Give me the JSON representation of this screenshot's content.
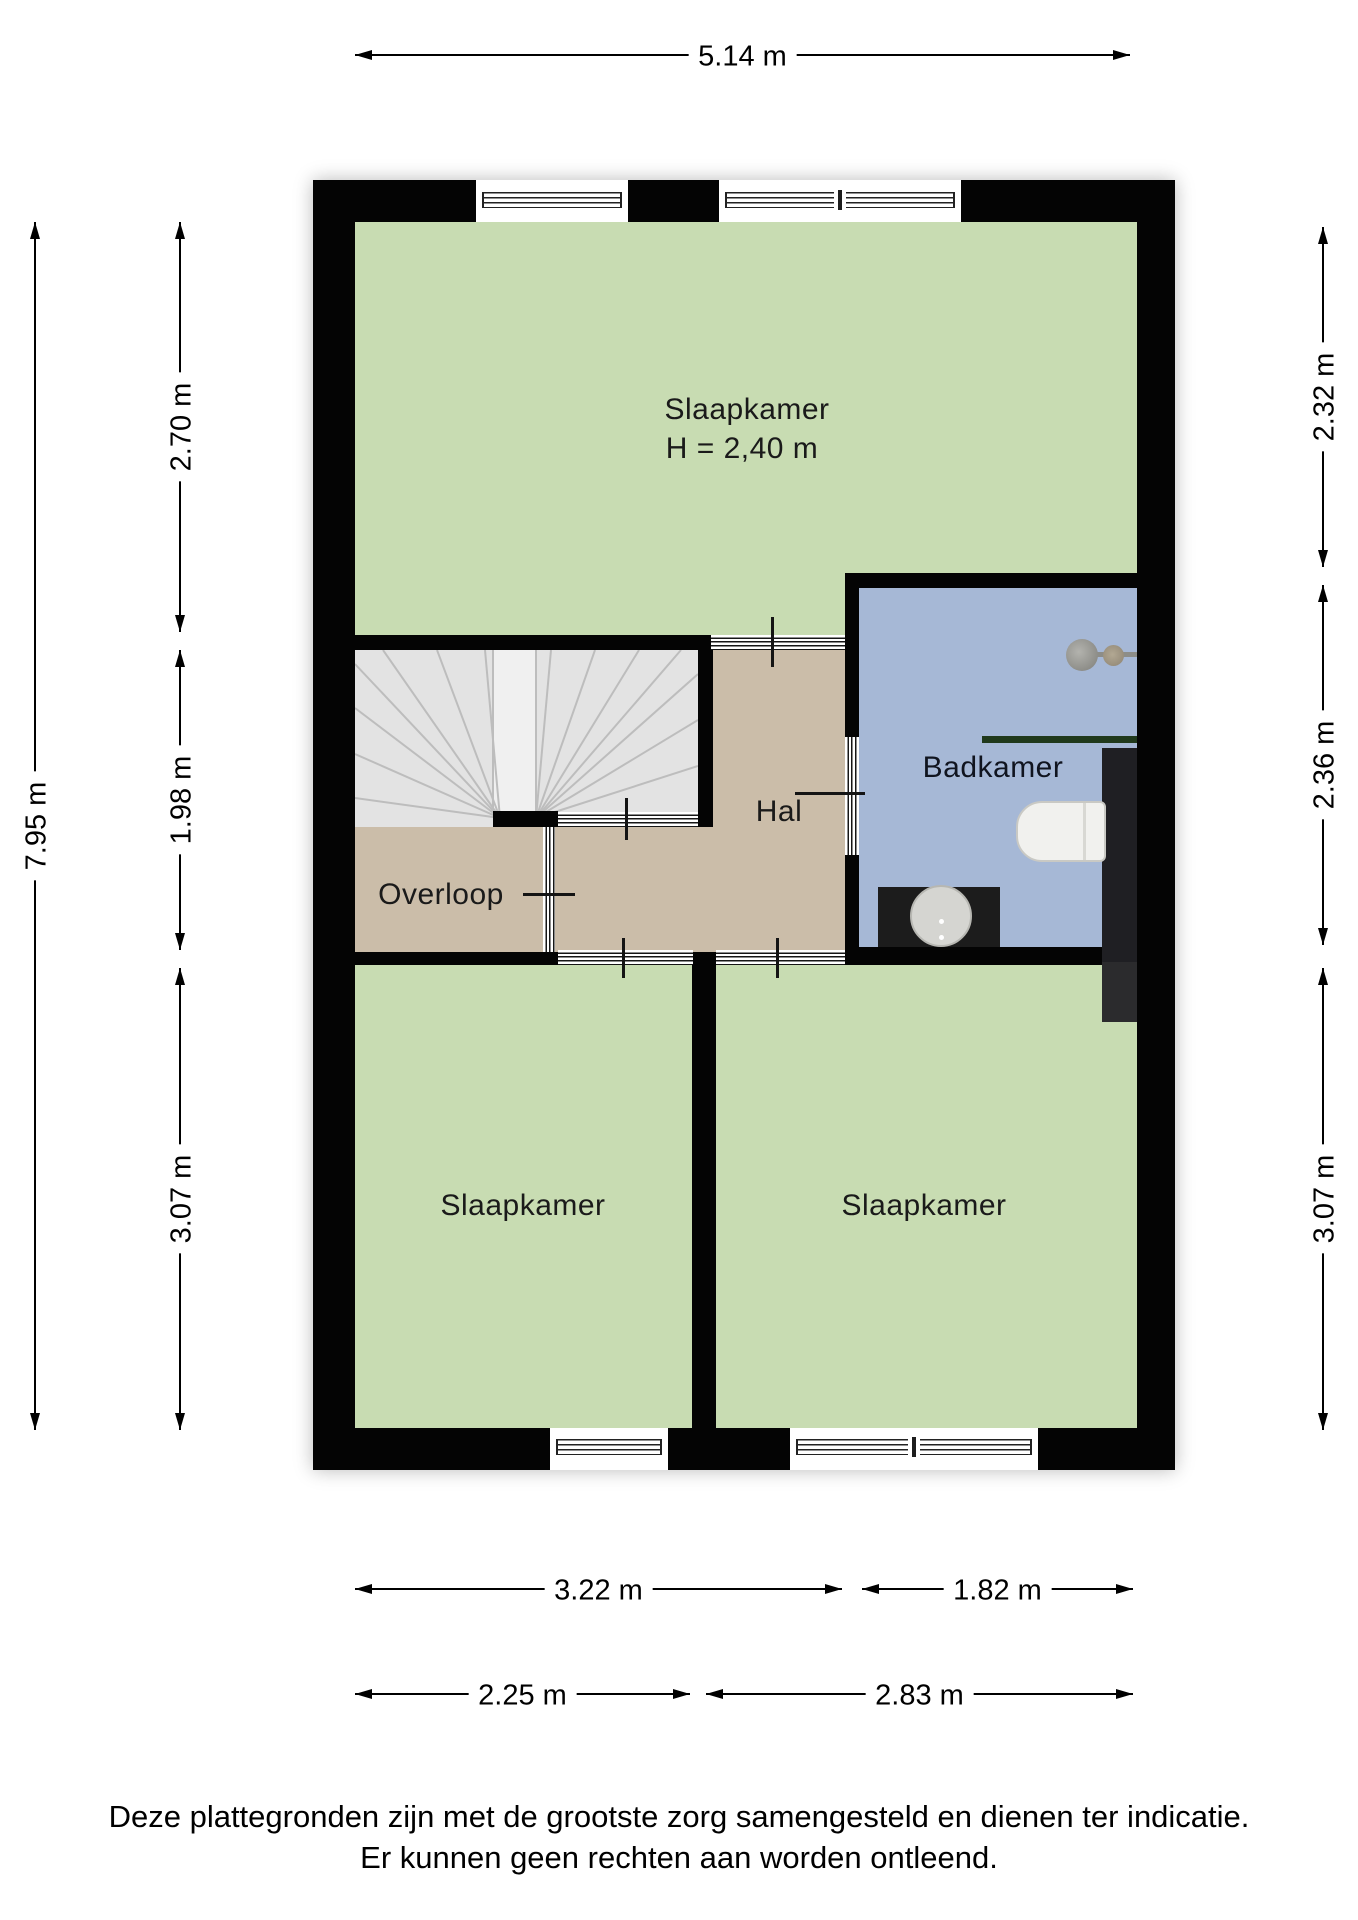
{
  "dimensions": {
    "top_width": "5.14 m",
    "left_total": "7.95 m",
    "left_segments": [
      "2.70 m",
      "1.98 m",
      "3.07 m"
    ],
    "right_segments": [
      "2.32 m",
      "2.36 m",
      "3.07 m"
    ],
    "bottom_row1": [
      "3.22 m",
      "1.82 m"
    ],
    "bottom_row2": [
      "2.25 m",
      "2.83 m"
    ]
  },
  "rooms": {
    "bedroom_top": {
      "label": "Slaapkamer",
      "ceiling_height": "H = 2,40 m"
    },
    "bathroom": {
      "label": "Badkamer"
    },
    "hall": {
      "label": "Hal"
    },
    "landing": {
      "label": "Overloop"
    },
    "bedroom_bottom_left": {
      "label": "Slaapkamer"
    },
    "bedroom_bottom_right": {
      "label": "Slaapkamer"
    }
  },
  "footer": {
    "line1": "Deze plattegronden zijn met de grootste zorg samengesteld en dienen ter indicatie.",
    "line2": "Er kunnen geen rechten aan worden ontleend."
  },
  "colors": {
    "room_green": "#c8dcb2",
    "room_tan": "#cbbda9",
    "room_blue": "#a6b8d6",
    "wall_black": "#040404",
    "stairs_gray": "#e3e3e3",
    "towel_bar_green": "#20391c"
  }
}
